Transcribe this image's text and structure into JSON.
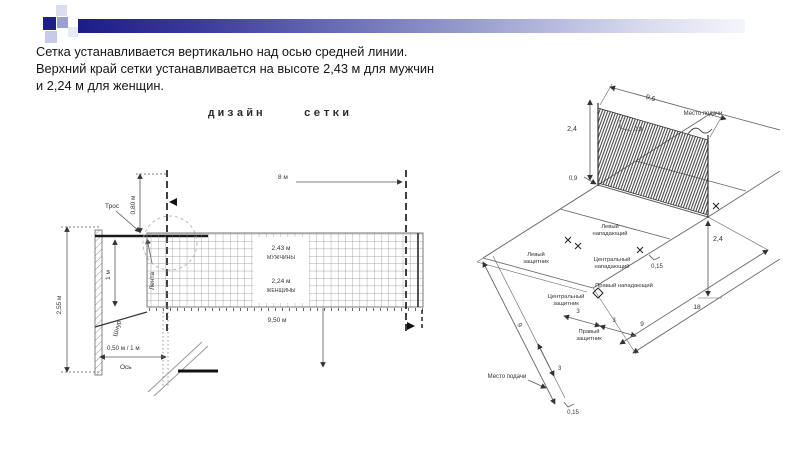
{
  "intro": {
    "line1": "Сетка устанавливается вертикально над осью средней линии.",
    "line2": "Верхний край сетки устанавливается на высоте 2,43 м для мужчин",
    "line3": "и 2,24 м для женщин."
  },
  "net_design": {
    "title": "дизайн    сетки",
    "labels": {
      "post_height": "2,55 м",
      "antenna_above": "0,80 м",
      "net_height": "1 м",
      "antenna_span": "8 м",
      "net_length": "9,50 м",
      "men_height": "2,43 м",
      "men": "МУЖЧИНЫ",
      "women_height": "2,24 м",
      "women": "ЖЕНЩИНЫ",
      "cable": "Трос",
      "band": "Лента",
      "cord": "Шнур",
      "post_offset": "0,50 м / 1 м",
      "axis": "Ось"
    }
  },
  "court": {
    "labels": {
      "net_height_left": "2,4",
      "net_height_right": "2,4",
      "net_length": "9,6",
      "band_top": "0,9",
      "band_bottom": "0,9",
      "line_width": "0,15",
      "line_width_bottom": "0,15",
      "serve_top": "Место подачи",
      "serve_bottom": "Место подачи",
      "dim_3a": "3",
      "dim_3b": "3",
      "dim_3c": "3",
      "dim_9_side": "9",
      "dim_9": "9",
      "dim_18": "18"
    },
    "players": {
      "left_attacker_1": "Левый",
      "left_attacker_2": "нападающий",
      "center_attacker_1": "Центральный",
      "center_attacker_2": "нападающий",
      "right_attacker": "Правый нападающий",
      "left_defender_1": "Левый",
      "left_defender_2": "защитник",
      "center_defender_1": "Центральный",
      "center_defender_2": "защитник",
      "right_defender_1": "Правый",
      "right_defender_2": "защитник"
    }
  }
}
